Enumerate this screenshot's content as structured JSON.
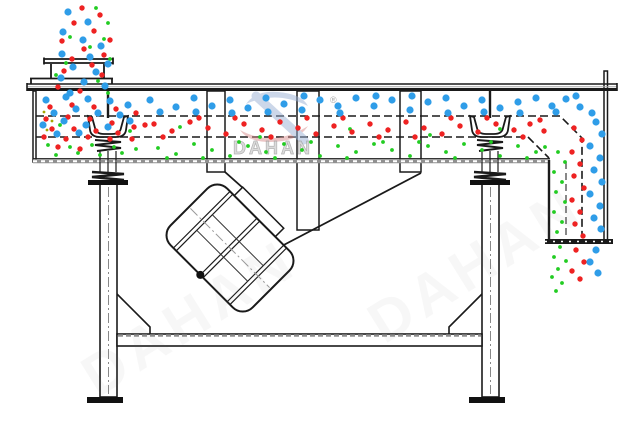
{
  "watermark": {
    "brand": "DAHAN",
    "registered": "®"
  },
  "colors": {
    "line": "#1a1a1a",
    "hatch_gray": "#909090",
    "coarse_blue": "#2f9de8",
    "medium_red": "#ee2222",
    "fine_green": "#22cc22",
    "trace_olive": "#a6a600",
    "watermark_blue": "#9ab0d4",
    "watermark_red": "#d98f8f"
  },
  "particles": {
    "coarse_blue": {
      "radius": 3.6,
      "color": "#2f9de8",
      "points": [
        [
          68,
          12
        ],
        [
          88,
          22
        ],
        [
          63,
          32
        ],
        [
          83,
          40
        ],
        [
          101,
          46
        ],
        [
          62,
          54
        ],
        [
          90,
          57
        ],
        [
          73,
          67
        ],
        [
          96,
          72
        ],
        [
          61,
          78
        ],
        [
          84,
          82
        ],
        [
          105,
          86
        ],
        [
          70,
          93
        ],
        [
          108,
          64
        ],
        [
          46,
          100
        ],
        [
          66,
          97
        ],
        [
          88,
          99
        ],
        [
          110,
          101
        ],
        [
          128,
          105
        ],
        [
          54,
          113
        ],
        [
          76,
          109
        ],
        [
          98,
          113
        ],
        [
          120,
          115
        ],
        [
          43,
          125
        ],
        [
          64,
          121
        ],
        [
          86,
          125
        ],
        [
          108,
          127
        ],
        [
          130,
          121
        ],
        [
          57,
          134
        ],
        [
          79,
          133
        ],
        [
          150,
          100
        ],
        [
          160,
          112
        ],
        [
          176,
          107
        ],
        [
          194,
          98
        ],
        [
          212,
          106
        ],
        [
          230,
          100
        ],
        [
          248,
          108
        ],
        [
          266,
          98
        ],
        [
          284,
          104
        ],
        [
          302,
          110
        ],
        [
          320,
          100
        ],
        [
          338,
          106
        ],
        [
          356,
          98
        ],
        [
          374,
          106
        ],
        [
          392,
          100
        ],
        [
          410,
          110
        ],
        [
          428,
          102
        ],
        [
          446,
          98
        ],
        [
          464,
          106
        ],
        [
          482,
          100
        ],
        [
          500,
          108
        ],
        [
          518,
          102
        ],
        [
          536,
          98
        ],
        [
          552,
          106
        ],
        [
          566,
          99
        ],
        [
          580,
          107
        ],
        [
          592,
          113
        ],
        [
          196,
          112
        ],
        [
          232,
          113
        ],
        [
          268,
          112
        ],
        [
          304,
          96
        ],
        [
          340,
          113
        ],
        [
          376,
          96
        ],
        [
          412,
          96
        ],
        [
          448,
          113
        ],
        [
          484,
          112
        ],
        [
          520,
          113
        ],
        [
          556,
          112
        ],
        [
          576,
          96
        ],
        [
          596,
          122
        ],
        [
          602,
          134
        ],
        [
          590,
          146
        ],
        [
          600,
          158
        ],
        [
          594,
          170
        ],
        [
          602,
          182
        ],
        [
          590,
          194
        ],
        [
          600,
          206
        ],
        [
          594,
          218
        ],
        [
          601,
          229
        ],
        [
          596,
          250
        ],
        [
          590,
          262
        ],
        [
          598,
          273
        ]
      ]
    },
    "medium_red": {
      "radius": 2.7,
      "color": "#ee2222",
      "points": [
        [
          82,
          8
        ],
        [
          100,
          15
        ],
        [
          74,
          23
        ],
        [
          94,
          31
        ],
        [
          62,
          41
        ],
        [
          84,
          49
        ],
        [
          104,
          55
        ],
        [
          72,
          59
        ],
        [
          92,
          65
        ],
        [
          64,
          71
        ],
        [
          102,
          75
        ],
        [
          80,
          91
        ],
        [
          58,
          87
        ],
        [
          110,
          40
        ],
        [
          50,
          107
        ],
        [
          72,
          105
        ],
        [
          94,
          107
        ],
        [
          116,
          109
        ],
        [
          136,
          113
        ],
        [
          46,
          119
        ],
        [
          68,
          117
        ],
        [
          90,
          119
        ],
        [
          112,
          123
        ],
        [
          134,
          127
        ],
        [
          52,
          129
        ],
        [
          74,
          129
        ],
        [
          96,
          131
        ],
        [
          118,
          133
        ],
        [
          44,
          137
        ],
        [
          66,
          139
        ],
        [
          88,
          137
        ],
        [
          110,
          139
        ],
        [
          132,
          139
        ],
        [
          58,
          147
        ],
        [
          80,
          149
        ],
        [
          145,
          125
        ],
        [
          154,
          124
        ],
        [
          172,
          131
        ],
        [
          190,
          122
        ],
        [
          208,
          128
        ],
        [
          226,
          134
        ],
        [
          244,
          124
        ],
        [
          262,
          130
        ],
        [
          280,
          122
        ],
        [
          298,
          128
        ],
        [
          316,
          134
        ],
        [
          334,
          126
        ],
        [
          352,
          132
        ],
        [
          370,
          124
        ],
        [
          388,
          130
        ],
        [
          406,
          122
        ],
        [
          424,
          128
        ],
        [
          442,
          134
        ],
        [
          460,
          126
        ],
        [
          478,
          132
        ],
        [
          496,
          124
        ],
        [
          514,
          130
        ],
        [
          530,
          124
        ],
        [
          544,
          131
        ],
        [
          163,
          137
        ],
        [
          199,
          118
        ],
        [
          235,
          118
        ],
        [
          271,
          137
        ],
        [
          307,
          118
        ],
        [
          343,
          118
        ],
        [
          379,
          137
        ],
        [
          415,
          137
        ],
        [
          451,
          118
        ],
        [
          487,
          118
        ],
        [
          523,
          137
        ],
        [
          540,
          120
        ],
        [
          574,
          128
        ],
        [
          582,
          140
        ],
        [
          572,
          152
        ],
        [
          580,
          164
        ],
        [
          574,
          176
        ],
        [
          584,
          188
        ],
        [
          572,
          200
        ],
        [
          580,
          212
        ],
        [
          575,
          224
        ],
        [
          583,
          236
        ],
        [
          576,
          250
        ],
        [
          584,
          262
        ],
        [
          572,
          271
        ],
        [
          580,
          279
        ]
      ]
    },
    "fine_green": {
      "radius": 1.9,
      "color": "#22cc22",
      "points": [
        [
          96,
          8
        ],
        [
          108,
          23
        ],
        [
          70,
          37
        ],
        [
          104,
          39
        ],
        [
          90,
          47
        ],
        [
          110,
          59
        ],
        [
          66,
          63
        ],
        [
          98,
          81
        ],
        [
          56,
          75
        ],
        [
          108,
          93
        ],
        [
          48,
          145
        ],
        [
          70,
          147
        ],
        [
          92,
          145
        ],
        [
          114,
          147
        ],
        [
          136,
          149
        ],
        [
          56,
          155
        ],
        [
          78,
          153
        ],
        [
          100,
          155
        ],
        [
          122,
          153
        ],
        [
          60,
          125
        ],
        [
          130,
          131
        ],
        [
          158,
          148
        ],
        [
          176,
          154
        ],
        [
          194,
          144
        ],
        [
          212,
          150
        ],
        [
          230,
          156
        ],
        [
          248,
          146
        ],
        [
          266,
          152
        ],
        [
          284,
          144
        ],
        [
          302,
          150
        ],
        [
          320,
          156
        ],
        [
          338,
          146
        ],
        [
          356,
          152
        ],
        [
          374,
          144
        ],
        [
          392,
          150
        ],
        [
          410,
          156
        ],
        [
          428,
          146
        ],
        [
          446,
          152
        ],
        [
          464,
          144
        ],
        [
          482,
          150
        ],
        [
          500,
          156
        ],
        [
          518,
          146
        ],
        [
          536,
          152
        ],
        [
          167,
          158
        ],
        [
          203,
          158
        ],
        [
          239,
          142
        ],
        [
          275,
          158
        ],
        [
          311,
          142
        ],
        [
          347,
          158
        ],
        [
          383,
          142
        ],
        [
          419,
          142
        ],
        [
          455,
          158
        ],
        [
          491,
          142
        ],
        [
          527,
          158
        ],
        [
          545,
          147
        ],
        [
          180,
          127
        ],
        [
          260,
          137
        ],
        [
          350,
          129
        ],
        [
          430,
          135
        ],
        [
          500,
          129
        ],
        [
          558,
          152
        ],
        [
          565,
          162
        ],
        [
          554,
          172
        ],
        [
          562,
          182
        ],
        [
          556,
          192
        ],
        [
          565,
          202
        ],
        [
          554,
          212
        ],
        [
          562,
          222
        ],
        [
          557,
          232
        ],
        [
          560,
          247
        ],
        [
          554,
          257
        ],
        [
          566,
          261
        ],
        [
          558,
          269
        ],
        [
          552,
          277
        ],
        [
          562,
          283
        ],
        [
          556,
          291
        ]
      ]
    },
    "trace_olive": {
      "radius": 1.4,
      "color": "#a6a600",
      "points": [
        [
          44,
          112
        ],
        [
          52,
          121
        ],
        [
          47,
          130
        ]
      ]
    }
  }
}
